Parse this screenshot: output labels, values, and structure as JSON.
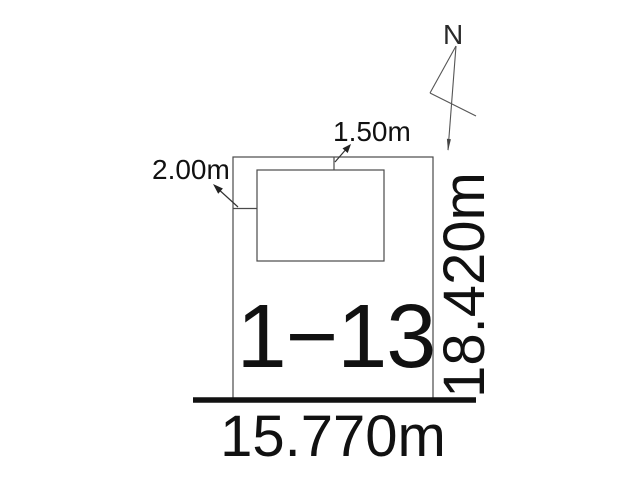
{
  "drawing": {
    "type": "land-plot-survey-diagram",
    "parcel": {
      "number": "1−13"
    },
    "dimensions": {
      "bottom_width": "15.770m",
      "right_height": "18.420m",
      "building_top_offset": "1.50m",
      "building_left_offset": "2.00m"
    },
    "north": {
      "label": "N"
    },
    "colors": {
      "background": "#ffffff",
      "ink": "#111111",
      "thin_line": "#4a4a4a",
      "ground_line": "#111111"
    }
  }
}
